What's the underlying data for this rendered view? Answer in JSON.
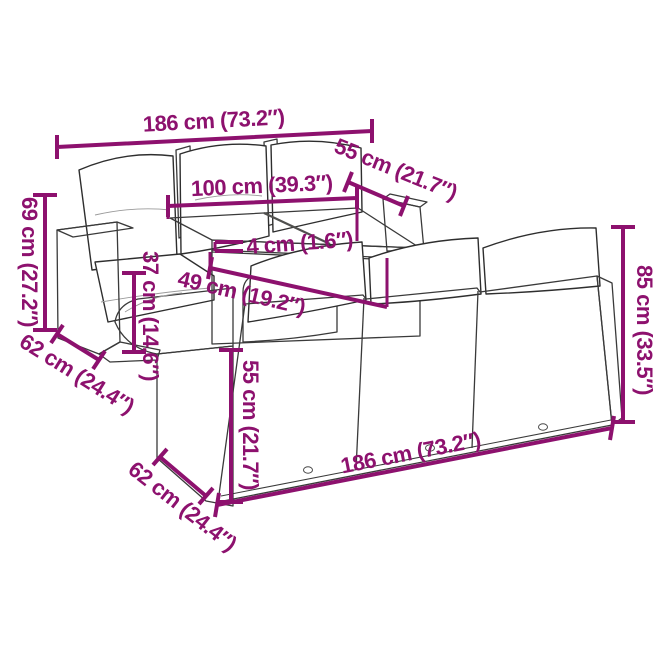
{
  "page": {
    "background": "#ffffff",
    "type": "product dimension diagram",
    "product": "poly rattan garden lounge sofa set with cushions and slatted wood table"
  },
  "style": {
    "dimension_color": "#8d116e",
    "sketch_line_color": "#3a3a3a",
    "rattan_fill": "#ededeb",
    "cushion_fill": "#ffffff"
  },
  "dimensions": {
    "back_sofa_width_top": {
      "label": "186 cm (73.2″)",
      "cm": 186,
      "inches": 73.2
    },
    "table_depth": {
      "label": "55 cm (21.7″)",
      "cm": 55,
      "inches": 21.7
    },
    "table_width": {
      "label": "100 cm (39.3″)",
      "cm": 100,
      "inches": 39.3
    },
    "back_sofa_height": {
      "label": "69 cm (27.2″)",
      "cm": 69,
      "inches": 27.2
    },
    "tabletop_thickness": {
      "label": "4 cm (1.6″)",
      "cm": 4,
      "inches": 1.6
    },
    "table_height": {
      "label": "37 cm (14.6″)",
      "cm": 37,
      "inches": 14.6
    },
    "seat_depth": {
      "label": "49 cm (19.2″)",
      "cm": 49,
      "inches": 19.2
    },
    "back_sofa_depth": {
      "label": "62 cm (24.4″)",
      "cm": 62,
      "inches": 24.4
    },
    "front_backrest_height": {
      "label": "55 cm (21.7″)",
      "cm": 55,
      "inches": 21.7
    },
    "front_sofa_height": {
      "label": "85 cm (33.5″)",
      "cm": 85,
      "inches": 33.5
    },
    "front_sofa_depth": {
      "label": "62 cm (24.4″)",
      "cm": 62,
      "inches": 24.4
    },
    "front_sofa_width_bottom": {
      "label": "186 cm (73.2″)",
      "cm": 186,
      "inches": 73.2
    }
  }
}
